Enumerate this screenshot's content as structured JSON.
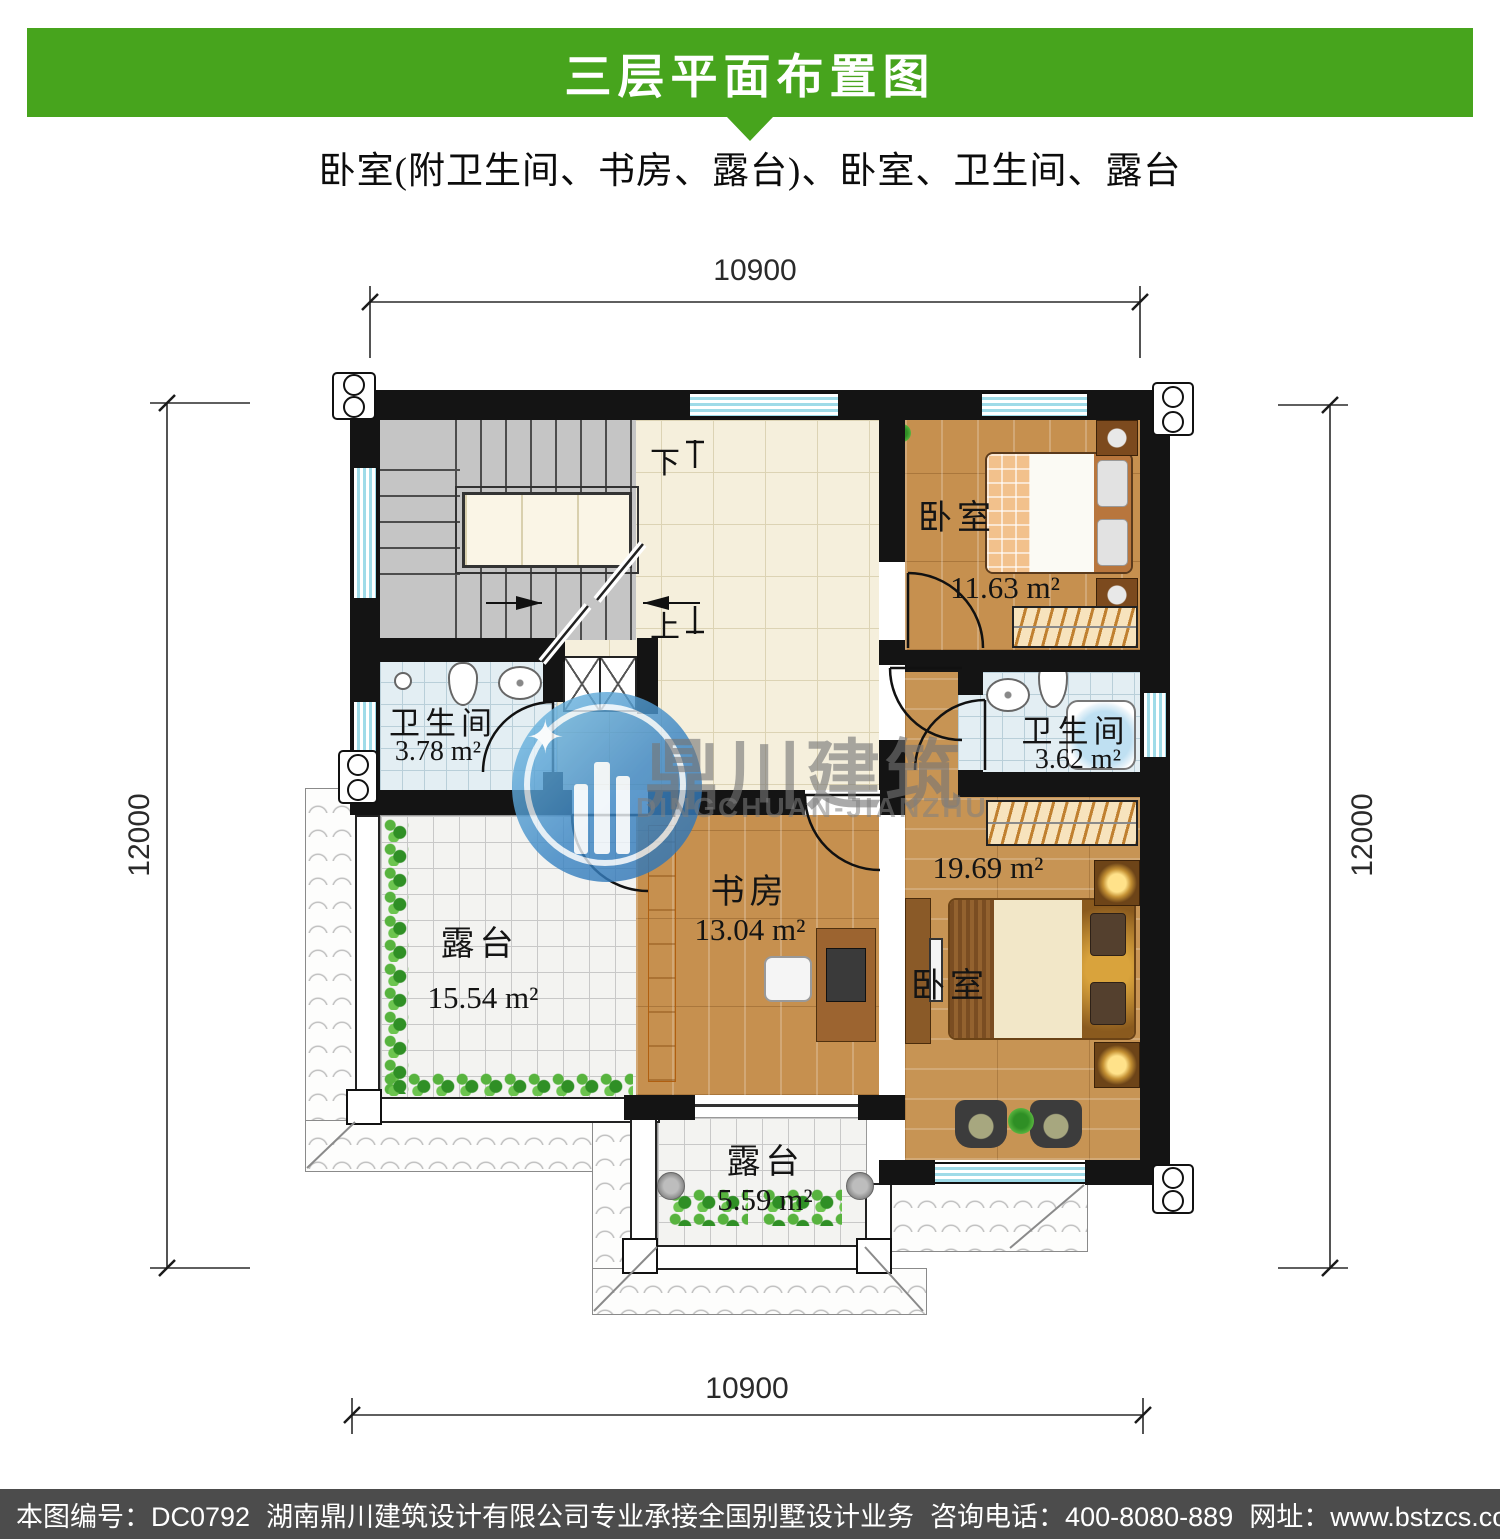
{
  "header": {
    "title": "三层平面布置图",
    "subtitle": "卧室(附卫生间、书房、露台)、卧室、卫生间、露台"
  },
  "footer": {
    "drawing_no": "本图编号：DC0792",
    "company": "湖南鼎川建筑设计有限公司专业承接全国别墅设计业务",
    "phone": "咨询电话：400-8080-889",
    "website": "网址：www.bstzcs.com"
  },
  "watermark": {
    "cn": "鼎川建筑",
    "en": "DINGCHUAN-JIANZHU",
    "logo_icon": "building-star-circle-logo"
  },
  "dimensions": {
    "top": "10900",
    "bottom": "10900",
    "left": "12000",
    "right": "12000"
  },
  "stairs": {
    "down_label": "下",
    "up_label": "上"
  },
  "rooms": [
    {
      "id": "bedroom-top",
      "name": "卧室",
      "area": "11.63 m²"
    },
    {
      "id": "bath-left",
      "name": "卫生间",
      "area": "3.78 m²"
    },
    {
      "id": "bath-right",
      "name": "卫生间",
      "area": "3.62 m²"
    },
    {
      "id": "study",
      "name": "书房",
      "area": "13.04 m²"
    },
    {
      "id": "bedroom-master",
      "name": "卧室",
      "area": "19.69 m²"
    },
    {
      "id": "terrace-left",
      "name": "露台",
      "area": "15.54 m²"
    },
    {
      "id": "terrace-bottom",
      "name": "露台",
      "area": "5.59 m²"
    }
  ],
  "colors": {
    "header_green": "#47a41d",
    "footer_gray": "#4c4c4c",
    "wall_black": "#141414",
    "wood_floor": "#c6904f",
    "bath_tile_blue": "#e3eef3",
    "window_blue": "#9fdbe8",
    "watermark_blue": "#3c86c4"
  }
}
